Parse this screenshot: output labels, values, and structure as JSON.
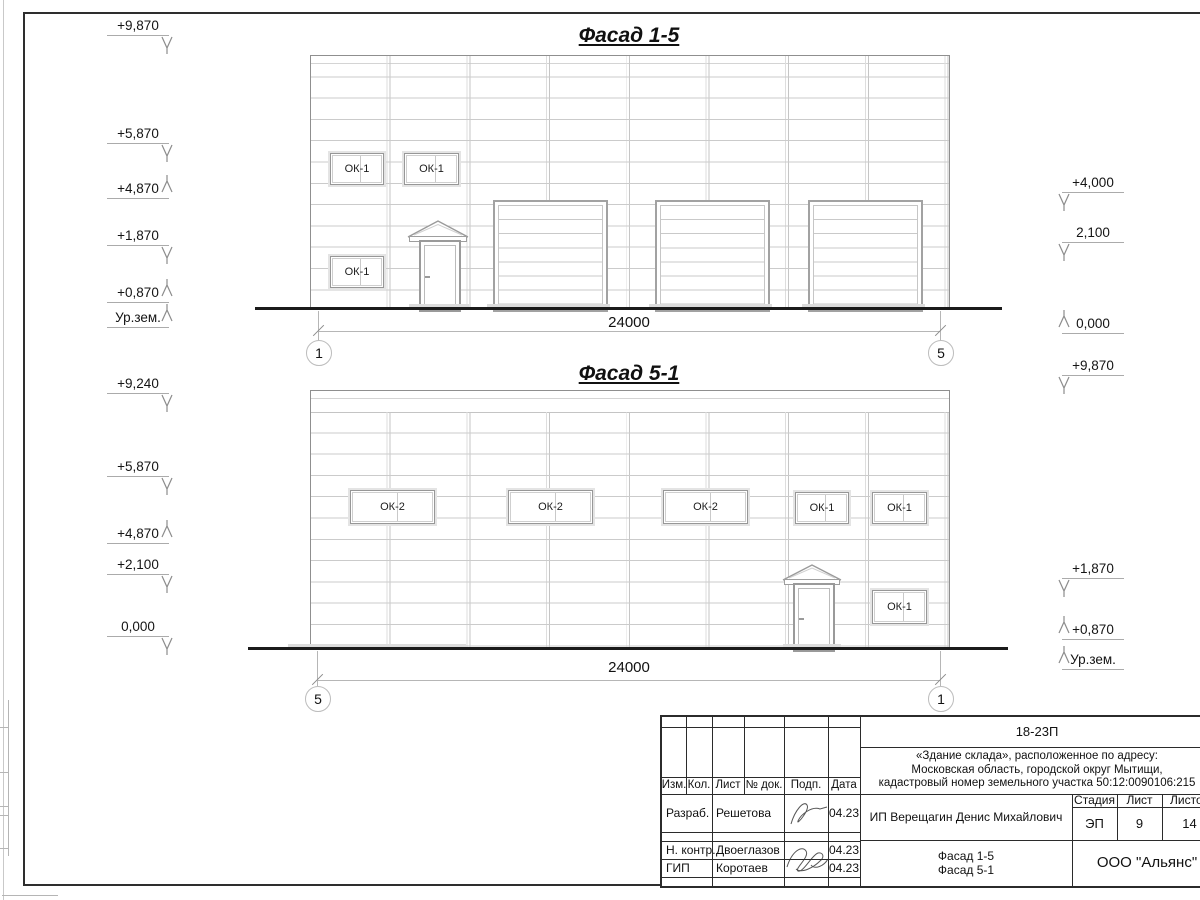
{
  "facade_top": {
    "title": "Фасад 1-5",
    "dimension": "24000",
    "axis_left": "1",
    "axis_right": "5",
    "windows": [
      "ОК-1",
      "ОК-1",
      "ОК-1"
    ],
    "levels_left": [
      {
        "value": "+9,870"
      },
      {
        "value": "+5,870"
      },
      {
        "value": "+4,870"
      },
      {
        "value": "+1,870"
      },
      {
        "value": "+0,870"
      },
      {
        "value": "Ур.зем."
      }
    ],
    "levels_right": [
      {
        "value": "+4,000"
      },
      {
        "value": "2,100"
      },
      {
        "value": "0,000"
      },
      {
        "value": "+9,870"
      }
    ]
  },
  "facade_bottom": {
    "title": "Фасад 5-1",
    "dimension": "24000",
    "axis_left": "5",
    "axis_right": "1",
    "windows": [
      "ОК-2",
      "ОК-2",
      "ОК-2",
      "ОК-1",
      "ОК-1",
      "ОК-1"
    ],
    "levels_left": [
      {
        "value": "+9,240"
      },
      {
        "value": "+5,870"
      },
      {
        "value": "+4,870"
      },
      {
        "value": "+2,100"
      },
      {
        "value": "0,000"
      }
    ],
    "levels_right": [
      {
        "value": "+1,870"
      },
      {
        "value": "+0,870"
      },
      {
        "value": "Ур.зем."
      }
    ]
  },
  "stamp": {
    "code": "18-23П",
    "address_lines": [
      "«Здание склада», расположенное по адресу:",
      "Московская область, городской округ Мытищи,",
      "кадастровый номер земельного участка 50:12:0090106:215"
    ],
    "columns": {
      "izm": "Изм.",
      "kol": "Кол.",
      "list": "Лист",
      "doc": "№ док.",
      "podp": "Подп.",
      "data": "Дата"
    },
    "rows": {
      "developer_role": "Разраб.",
      "developer_name": "Решетова",
      "developer_date": "04.23",
      "ncontrol_role": "Н. контр.",
      "ncontrol_name": "Двоеглазов",
      "ncontrol_date": "04.23",
      "gip_role": "ГИП",
      "gip_name": "Коротаев",
      "gip_date": "04.23"
    },
    "client": "ИП Верещагин Денис Михайлович",
    "stage_label": "Стадия",
    "sheet_label": "Лист",
    "sheets_label": "Листов",
    "stage": "ЭП",
    "sheet_number": "9",
    "sheets_total": "14",
    "drawing_title_lines": [
      "Фасад 1-5",
      "Фасад 5-1"
    ],
    "company": "ООО \"Альянс\""
  }
}
